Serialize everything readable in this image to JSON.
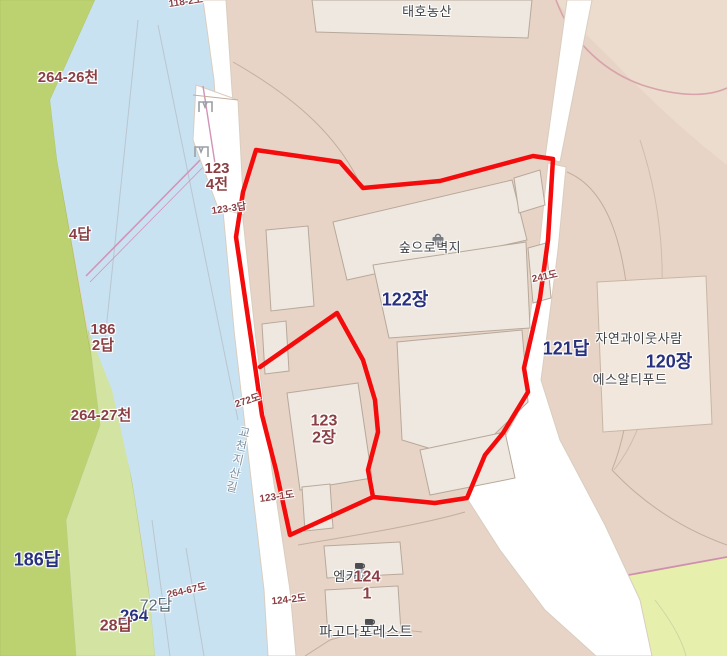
{
  "labels": {
    "taeho": "태호농산",
    "p118_2": "118-2도",
    "p264_26": "264-26천",
    "p123_4": "123\n4전",
    "p123_3": "123-3답",
    "p4": "4답",
    "p186_2": "186\n2답",
    "p264_27": "264-27천",
    "p272": "272도",
    "road_gyocheon": "교천지산길",
    "p123_1": "123-1도",
    "soop": "숲으로벽지",
    "z122": "122장",
    "p241": "241도",
    "z121": "121답",
    "nature": "자연과이웃사람",
    "z120": "120장",
    "srt": "에스알티푸드",
    "p123_2": "123\n2장",
    "z186": "186답",
    "p264_67": "264-67도",
    "p72": "72답",
    "z264": "264",
    "p28": "28답",
    "mcafe": "엠카페",
    "p124_1": "124\n1",
    "p124_2": "124-2도",
    "pagoda": "파고다포레스트"
  },
  "icons": {
    "soop_icon": "shopping-bag",
    "mcafe_icon": "coffee-cup",
    "pagoda_icon": "coffee-cup",
    "marker_top": "boundary-marker",
    "marker_bottom": "boundary-marker"
  },
  "colors": {
    "selection_outline": "#f40b0b",
    "river": "#c9e2f1",
    "field_dark": "#bcd271",
    "field_light": "#d2e3a2",
    "field_corner": "#e7efad",
    "land": "#e7d4c6",
    "building": "#efe8e0",
    "road": "#ffffff",
    "parcel_text": "#8a3f44",
    "zone_text": "#28317e",
    "poi_text": "#3f4247",
    "road_text": "#8292a4"
  }
}
